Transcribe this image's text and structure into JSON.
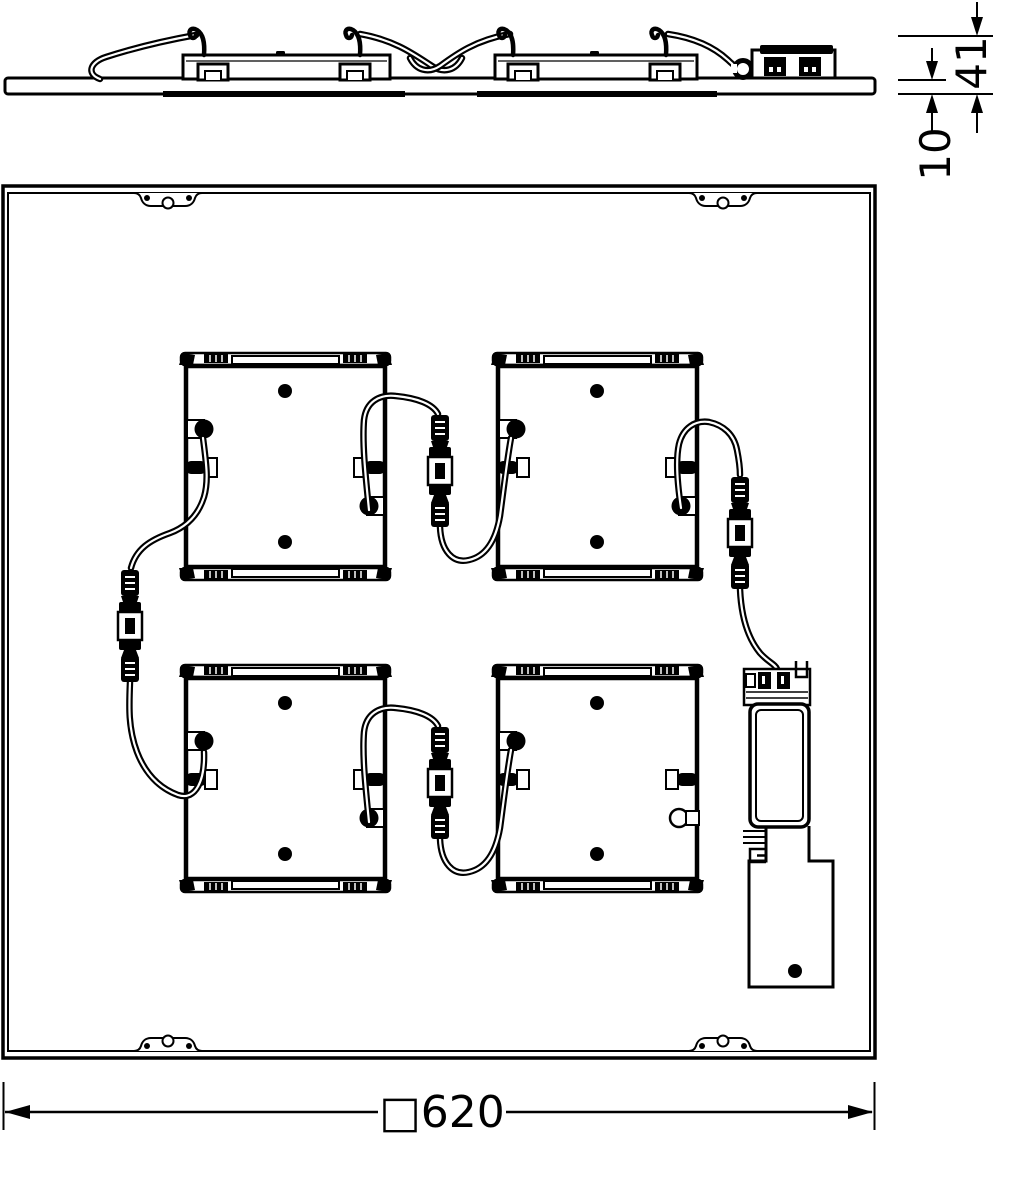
{
  "drawing": {
    "type": "luminaire-dimension-drawing",
    "views": {
      "side_view": "side-profile-of-panel-with-modules-and-driver",
      "plan_view": "rear-view-of-square-panel"
    },
    "dimension_labels": {
      "total_height": "41",
      "panel_thickness": "10",
      "outer_square": "□620"
    },
    "components": {
      "led_module_count": 4,
      "inline_connector_count": 4,
      "mounting_tab_count": 4,
      "parts": [
        "led-module",
        "inline-cable-connector",
        "driver-unit",
        "terminal-block",
        "mounting-tab",
        "cable"
      ]
    },
    "colors": {
      "line": "#000000",
      "background": "#ffffff"
    }
  }
}
